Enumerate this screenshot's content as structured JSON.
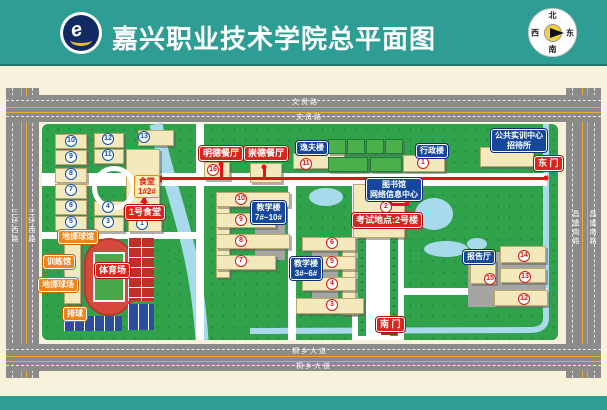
{
  "header": {
    "title": "嘉兴职业技术学院总平面图",
    "logo": "school-emblem",
    "compass": {
      "north": "北",
      "south": "南",
      "east": "东",
      "west": "西"
    }
  },
  "roads": {
    "top_label": "文贤路",
    "bottom_label": "桐乡大道",
    "left_label": "三环西路",
    "right_label": "昌盛南路"
  },
  "map": {
    "accent_route_color": "#E41212",
    "labels_red": [
      {
        "text": "明德餐厅",
        "x": 199,
        "y": 146
      },
      {
        "text": "崇德餐厅",
        "x": 244,
        "y": 146
      },
      {
        "text": "1号食堂",
        "x": 125,
        "y": 205
      },
      {
        "text": "考试地点:2号楼",
        "x": 352,
        "y": 213
      },
      {
        "text": "东 门",
        "x": 534,
        "y": 156
      },
      {
        "text": "南 门",
        "x": 376,
        "y": 317
      },
      {
        "text": "体育场",
        "x": 95,
        "y": 263
      }
    ],
    "labels_blue": [
      {
        "text": "逸夫楼",
        "x": 296,
        "y": 141
      },
      {
        "text": "行政楼",
        "x": 416,
        "y": 144
      },
      {
        "text": "公共实训中心\n招待所",
        "x": 491,
        "y": 129
      },
      {
        "text": "图书馆\n网络信息中心",
        "x": 366,
        "y": 178
      },
      {
        "text": "教学楼\n7#~10#",
        "x": 251,
        "y": 201
      },
      {
        "text": "教学楼\n3#~6#",
        "x": 290,
        "y": 257
      },
      {
        "text": "报告厅",
        "x": 463,
        "y": 250
      }
    ],
    "labels_orange": [
      {
        "text": "地掷球馆",
        "x": 58,
        "y": 230
      },
      {
        "text": "训练馆",
        "x": 43,
        "y": 255
      },
      {
        "text": "地掷球场",
        "x": 38,
        "y": 278
      },
      {
        "text": "排球",
        "x": 63,
        "y": 307
      }
    ],
    "labels_canteen": [
      {
        "text": "食堂\n1#2#",
        "x": 134,
        "y": 175
      }
    ],
    "dorm_numbers_blue": [
      {
        "n": "10",
        "x": 71,
        "y": 141
      },
      {
        "n": "9",
        "x": 71,
        "y": 157
      },
      {
        "n": "8",
        "x": 71,
        "y": 174
      },
      {
        "n": "7",
        "x": 71,
        "y": 190
      },
      {
        "n": "6",
        "x": 71,
        "y": 206
      },
      {
        "n": "5",
        "x": 71,
        "y": 222
      },
      {
        "n": "12",
        "x": 108,
        "y": 139
      },
      {
        "n": "11",
        "x": 108,
        "y": 155
      },
      {
        "n": "4",
        "x": 108,
        "y": 207
      },
      {
        "n": "3",
        "x": 108,
        "y": 222
      },
      {
        "n": "13",
        "x": 144,
        "y": 137
      },
      {
        "n": "1",
        "x": 142,
        "y": 224
      }
    ],
    "building_numbers_red": [
      {
        "n": "1",
        "x": 423,
        "y": 163
      },
      {
        "n": "2",
        "x": 386,
        "y": 207
      },
      {
        "n": "3",
        "x": 332,
        "y": 305
      },
      {
        "n": "4",
        "x": 332,
        "y": 284
      },
      {
        "n": "5",
        "x": 332,
        "y": 262
      },
      {
        "n": "6",
        "x": 332,
        "y": 243
      },
      {
        "n": "7",
        "x": 241,
        "y": 261
      },
      {
        "n": "8",
        "x": 241,
        "y": 241
      },
      {
        "n": "9",
        "x": 241,
        "y": 220
      },
      {
        "n": "10",
        "x": 241,
        "y": 199
      },
      {
        "n": "11",
        "x": 306,
        "y": 164
      },
      {
        "n": "12",
        "x": 524,
        "y": 299
      },
      {
        "n": "13",
        "x": 525,
        "y": 277
      },
      {
        "n": "14",
        "x": 524,
        "y": 256
      },
      {
        "n": "15",
        "x": 490,
        "y": 279
      },
      {
        "n": "16",
        "x": 213,
        "y": 170
      }
    ]
  }
}
